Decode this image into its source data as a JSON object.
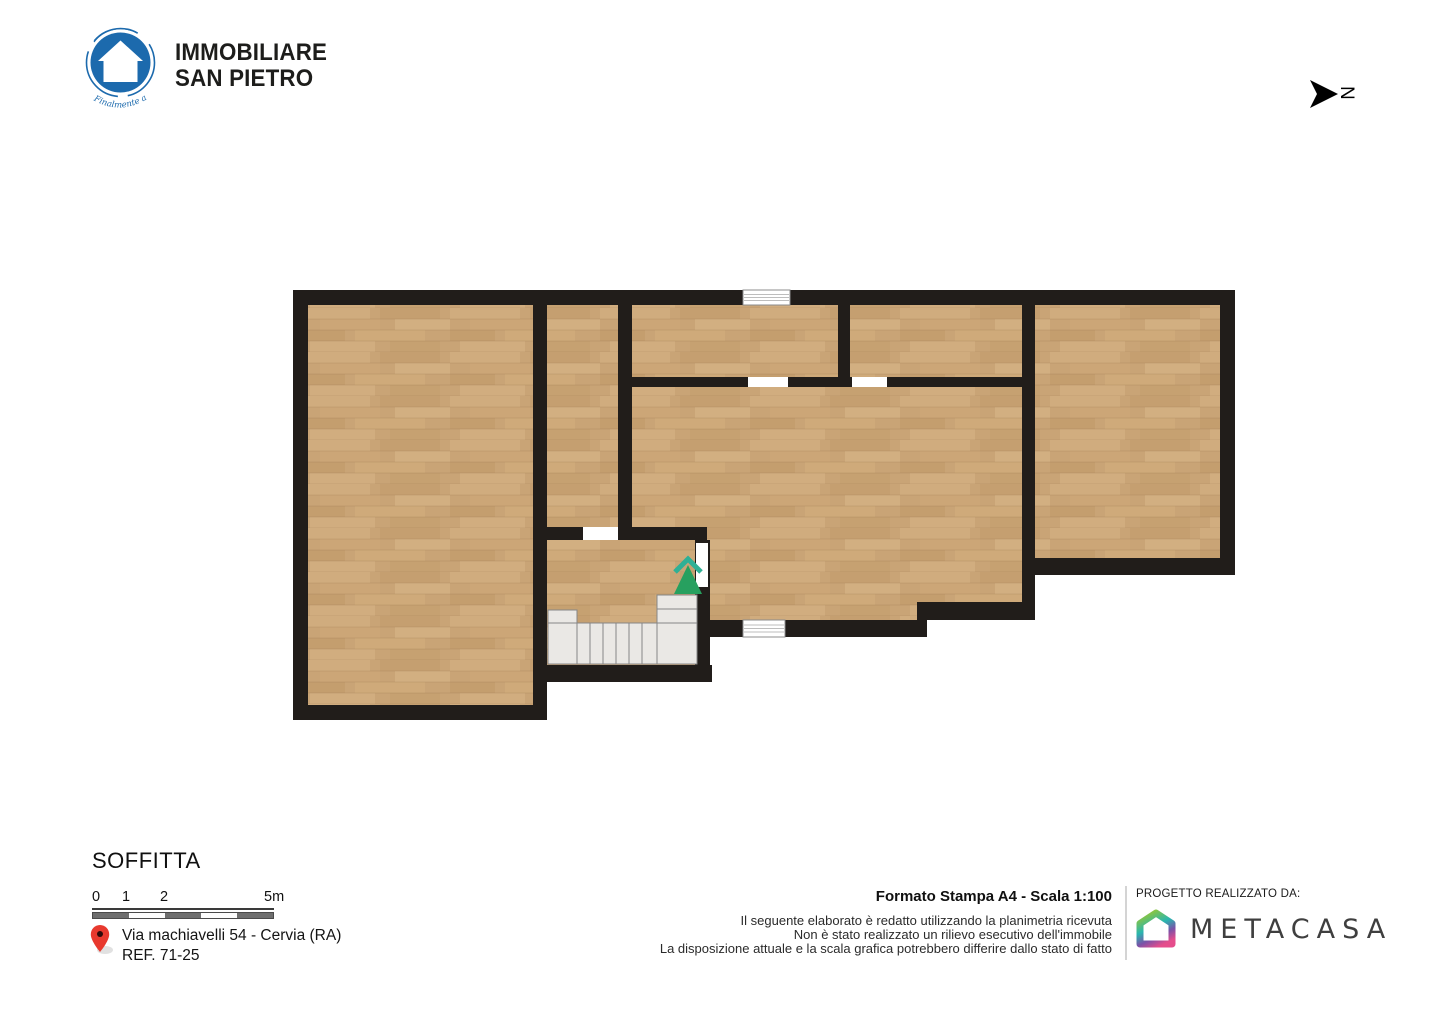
{
  "header": {
    "agency_name_line1": "IMMOBILIARE",
    "agency_name_line2": "SAN PIETRO",
    "agency_tagline": "Finalmente a Casa",
    "north_label": "N"
  },
  "plan": {
    "floor_title": "SOFFITTA",
    "scale_bar": {
      "labels": [
        "0",
        "1",
        "2",
        "5m"
      ]
    },
    "address_line1": "Via machiavelli 54 - Cervia (RA)",
    "address_line2": "REF. 71-25"
  },
  "footer": {
    "print_format": "Formato Stampa A4 - Scala 1:100",
    "disclaimer": [
      "Il seguente elaborato è redatto utilizzando la planimetria ricevuta",
      "Non è stato realizzato un rilievo esecutivo dell'immobile",
      "La disposizione attuale e la scala grafica potrebbero differire dallo stato di fatto"
    ],
    "credit_label": "PROGETTO REALIZZATO DA:",
    "credit_brand": "METACASA"
  },
  "colors": {
    "agency_blue": "#1c6aad",
    "wall_black": "#211d1a",
    "wood_base": "#c9a476",
    "stair_gray": "#eae8e5",
    "arrow_green": "#27a05f",
    "arrow_teal": "#2fb095",
    "pin_red": "#e8392e"
  }
}
